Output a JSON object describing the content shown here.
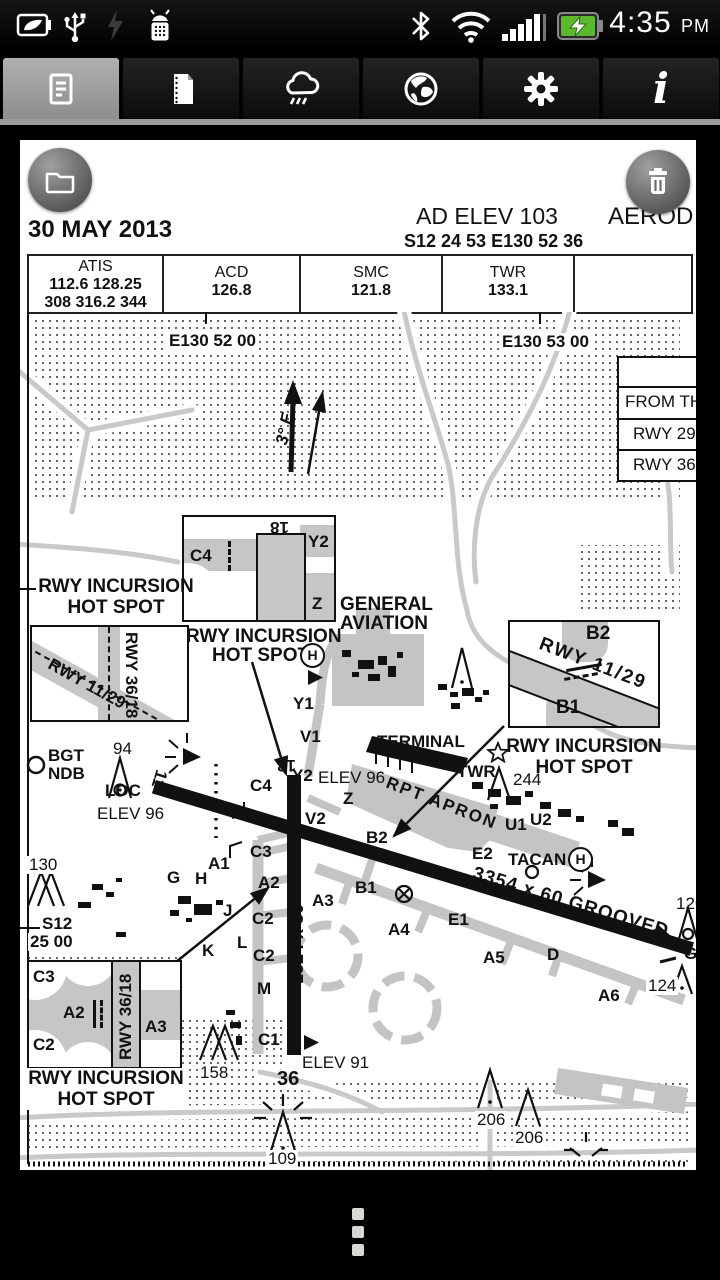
{
  "status": {
    "time": "4:35",
    "ampm": "PM",
    "left_icons": [
      "battery-saver",
      "usb",
      "lightning-dim",
      "android-debug"
    ],
    "right_icons": [
      "bluetooth",
      "wifi",
      "signal-strength",
      "battery-charging"
    ]
  },
  "tabs": [
    {
      "name": "charts",
      "icon": "document-icon",
      "selected": true
    },
    {
      "name": "documents",
      "icon": "notepad-icon",
      "selected": false
    },
    {
      "name": "weather",
      "icon": "rain-cloud-icon",
      "selected": false
    },
    {
      "name": "web",
      "icon": "globe-icon",
      "selected": false
    },
    {
      "name": "settings",
      "icon": "gear-icon",
      "selected": false
    },
    {
      "name": "info",
      "icon": "info-icon",
      "glyph": "i",
      "selected": false
    }
  ],
  "chart": {
    "date": "30 MAY 2013",
    "ad_elev": "AD ELEV 103",
    "coords": "S12 24 53  E130 52 36",
    "title_clip": "AEROD",
    "freq": {
      "cols": [
        {
          "title": "ATIS",
          "line1": "112.6  128.25",
          "line2": "308  316.2  344"
        },
        {
          "title": "ACD",
          "line1": "126.8",
          "line2": ""
        },
        {
          "title": "SMC",
          "line1": "121.8",
          "line2": ""
        },
        {
          "title": "TWR",
          "line1": "133.1",
          "line2": ""
        },
        {
          "title": "",
          "line1": "",
          "line2": ""
        }
      ]
    },
    "info_rows": [
      "",
      "FROM TH",
      "RWY 29",
      "RWY 36"
    ],
    "map": {
      "labels": [
        "E130 52 00",
        "E130 53 00",
        "3° E",
        "18",
        "C4",
        "Y2",
        "Z",
        "RWY INCURSION",
        "HOT SPOT",
        "RWY 36/18",
        "RWY 11/29",
        "RWY INCURSION",
        "HOT SPOT",
        "H",
        "GENERAL",
        "AVIATION",
        "B2",
        "RWY 11/29",
        "B1",
        "RWY INCURSION",
        "HOT SPOT",
        "BGT",
        "NDB",
        "94",
        "LOC",
        "ELEV 96",
        "130",
        "S12",
        "25 00",
        "Y1",
        "V1",
        "TERMINAL",
        "RPT APRON",
        "TWR",
        "244",
        "U1",
        "U2",
        "C4",
        "Y2",
        "ELEV 96",
        "Z",
        "V2",
        "B2",
        "18",
        "11",
        "C3",
        "A1",
        "G",
        "H",
        "A2",
        "B1",
        "A3",
        "J",
        "C2",
        "K",
        "L",
        "C2",
        "M",
        "1524 x 30",
        "3354 x 60 GROOVED",
        "E2",
        "TACAN",
        "H",
        "E1",
        "A4",
        "A5",
        "D",
        "A6",
        "124",
        "126",
        "GR",
        "C1",
        "36",
        "ELEV 91",
        "158",
        "206",
        "206",
        "109",
        "C3",
        "A2",
        "C2",
        "RWY 36/18",
        "A3",
        "RWY INCURSION",
        "HOT SPOT"
      ]
    }
  }
}
